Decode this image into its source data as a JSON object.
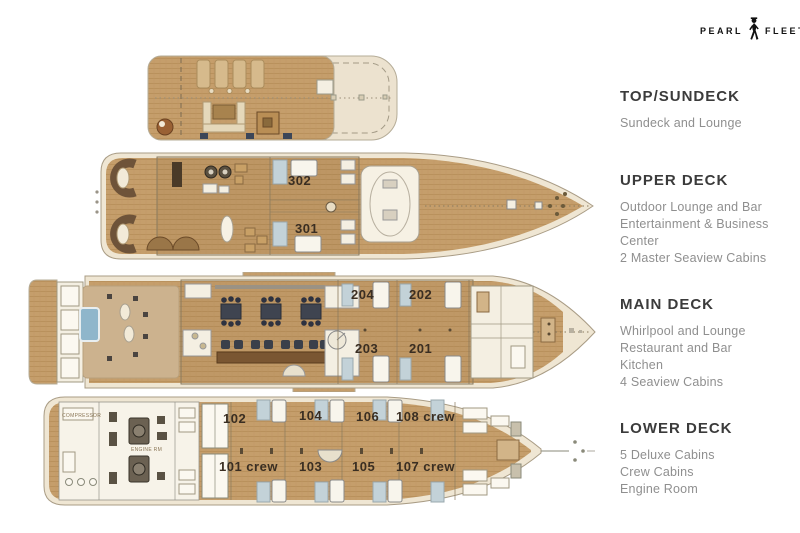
{
  "logo": {
    "word1": "PEARL",
    "word2": "FLEET"
  },
  "panel": {
    "sections": [
      {
        "title": "TOP/SUNDECK",
        "lines": [
          "Sundeck and Lounge"
        ]
      },
      {
        "title": "UPPER DECK",
        "lines": [
          "Outdoor Lounge and Bar",
          "Entertainment & Business Center",
          "2 Master Seaview Cabins"
        ]
      },
      {
        "title": "MAIN DECK",
        "lines": [
          "Whirlpool and Lounge",
          "Restaurant and Bar",
          "Kitchen",
          "4 Seaview Cabins"
        ]
      },
      {
        "title": "LOWER DECK",
        "lines": [
          "5 Deluxe Cabins",
          "Crew Cabins",
          "Engine Room"
        ]
      }
    ]
  },
  "decks": {
    "upper": {
      "cabin_302": "302",
      "cabin_301": "301"
    },
    "main": {
      "cabin_204": "204",
      "cabin_202": "202",
      "cabin_203": "203",
      "cabin_201": "201"
    },
    "lower": {
      "cabin_102": "102",
      "cabin_101": "101 crew",
      "cabin_104": "104",
      "cabin_106": "106",
      "cabin_108": "108 crew",
      "cabin_103": "103",
      "cabin_105": "105",
      "cabin_107": "107 crew",
      "engine_room_label": "ENGINE RM",
      "compressor_label": "COMPRESSOR"
    }
  },
  "colors": {
    "deck_wood": "#c59e6b",
    "hull_cream": "#efe6d3",
    "whirlpool_blue": "#8fb6cb",
    "tile_blue": "#c3d2d8",
    "sofa_dark": "#6e5339",
    "navy": "#3c4658"
  }
}
